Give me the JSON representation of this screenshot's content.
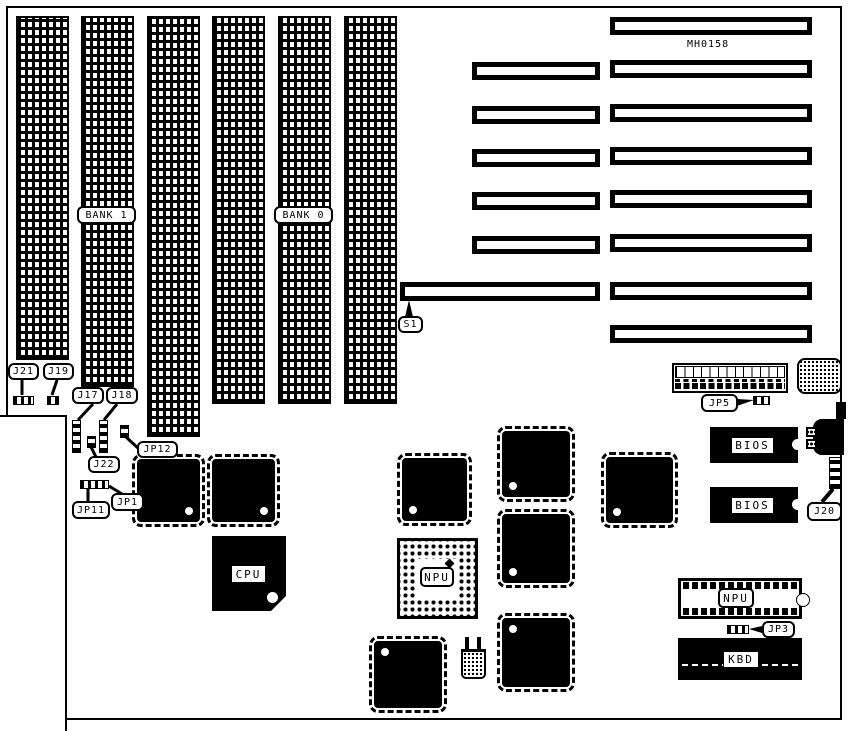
{
  "board": {
    "part_number": "MH0158",
    "banks": [
      {
        "label": "BANK 1"
      },
      {
        "label": "BANK 0"
      }
    ],
    "callouts": {
      "j21": "J21",
      "j19": "J19",
      "j17": "J17",
      "j18": "J18",
      "jp12": "JP12",
      "j22": "J22",
      "jp11": "JP11",
      "jp1": "JP1",
      "s1": "S1",
      "jp5": "JP5",
      "j20": "J20",
      "jp3": "JP3"
    },
    "chips": {
      "cpu": "CPU",
      "npu_socket": "NPU",
      "npu_dip": "NPU",
      "bios_top": "BIOS",
      "bios_bottom": "BIOS",
      "kbd": "KBD"
    }
  }
}
